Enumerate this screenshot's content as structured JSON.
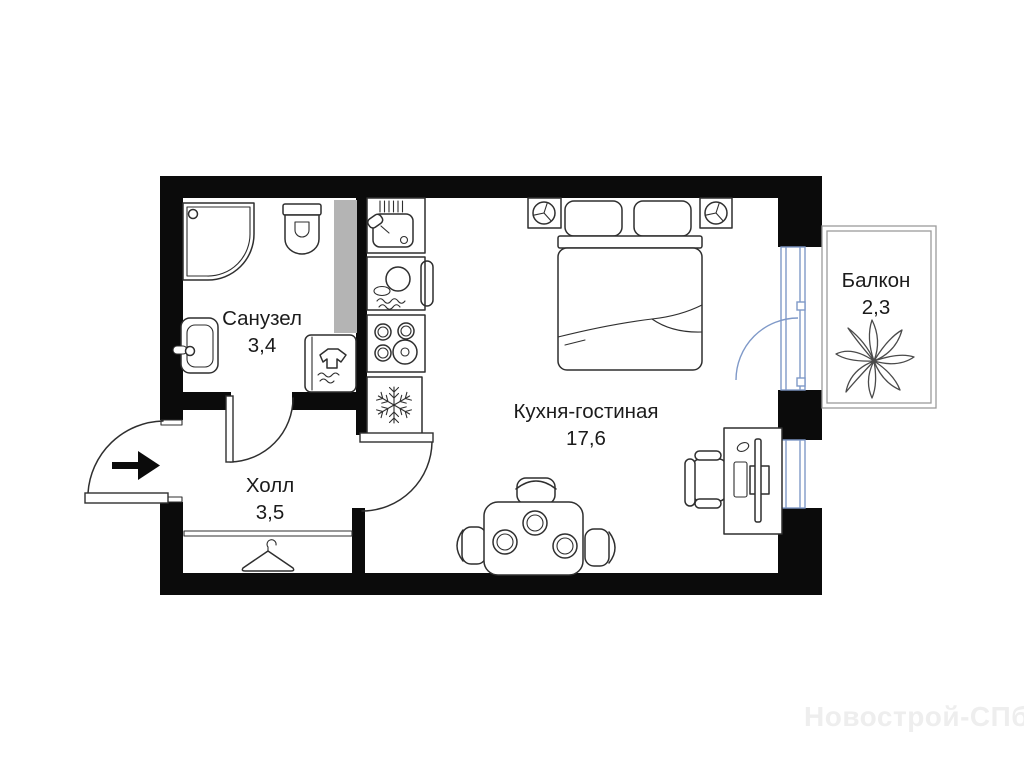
{
  "plan": {
    "rooms": [
      {
        "id": "bathroom",
        "name": "Санузел",
        "area": "3,4"
      },
      {
        "id": "hall",
        "name": "Холл",
        "area": "3,5"
      },
      {
        "id": "kitchen_living",
        "name": "Кухня-гостиная",
        "area": "17,6"
      },
      {
        "id": "balcony",
        "name": "Балкон",
        "area": "2,3"
      }
    ],
    "watermark": "Новострой-СПб",
    "colors": {
      "wall": "#0b0b0b",
      "line": "#2f2f2f",
      "window": "#7f99c8",
      "shaft": "#b4b4b4",
      "balcony": "#9b9b9b",
      "watermark": "#eeeeee"
    }
  }
}
